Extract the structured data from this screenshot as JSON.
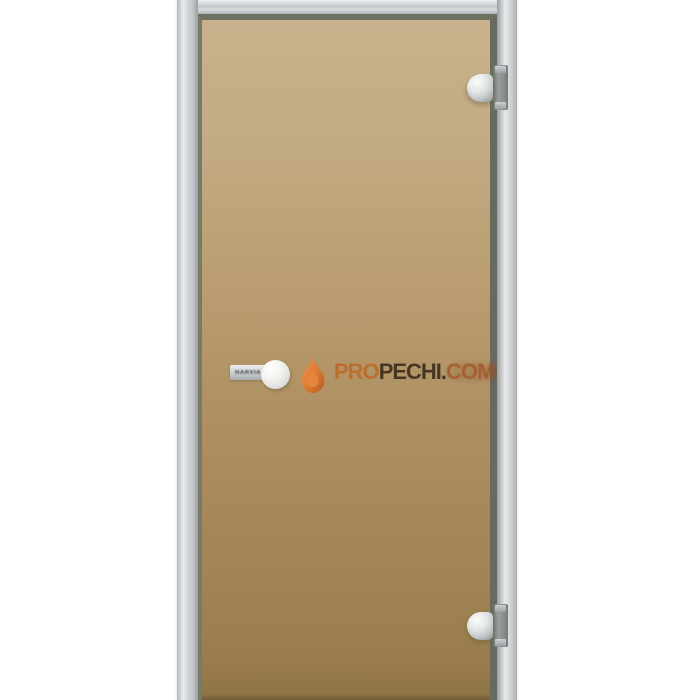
{
  "scene": {
    "background": "#ffffff",
    "subject": "sauna glass door with aluminium frame, bronze tinted glass, two hinges on the right and a round knob handle on the left"
  },
  "door": {
    "frame_color": "#ccd0d2",
    "inner_edge_color": "#6f705f",
    "glass_top_color": "#c8b18c",
    "glass_bottom_color": "#8d7343",
    "hinge_color": "#d9dcde",
    "hinge_positions": [
      "top-right",
      "bottom-right"
    ]
  },
  "handle": {
    "label": "HARVIA",
    "knob_color": "#f2f2ef"
  },
  "watermark": {
    "icon": "flame-icon",
    "flame_color": "#d97a33",
    "segments": [
      {
        "text": "PRO",
        "color": "#bd6a2a"
      },
      {
        "text": "PECHI.",
        "color": "#3d2f1d"
      },
      {
        "text": "COM",
        "color": "#a04f24"
      }
    ]
  }
}
